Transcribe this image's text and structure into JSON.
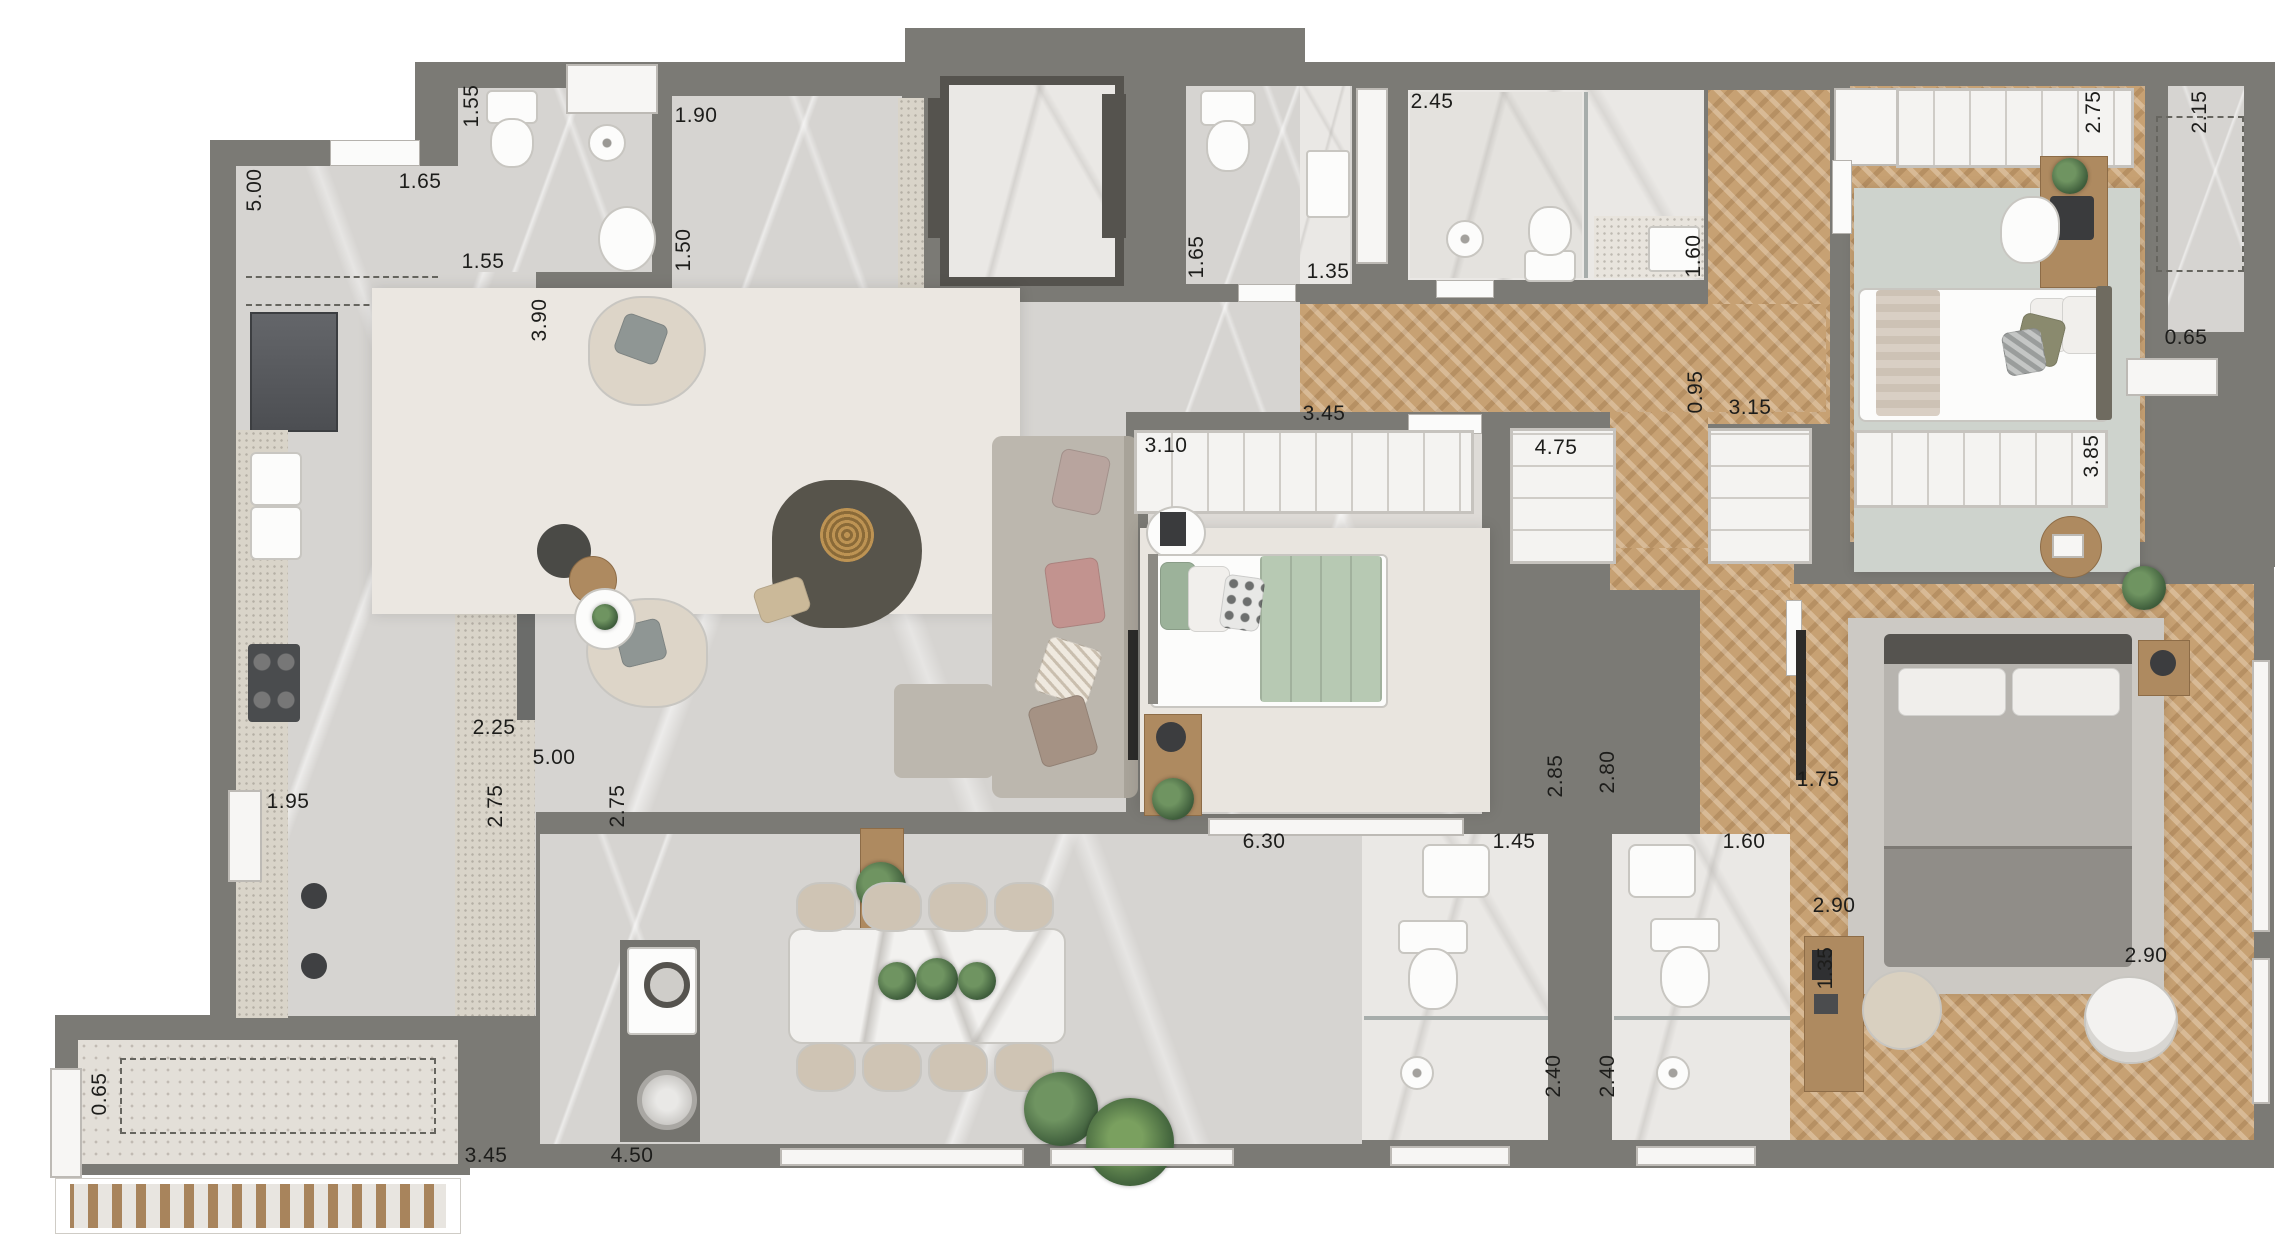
{
  "plan": {
    "canvas": {
      "width": 2280,
      "height": 1257
    },
    "colors": {
      "wall": "#7b7a75",
      "floor_gray_marble": "#d6d4d1",
      "floor_white_marble": "#eae8e5",
      "wood_herringbone": "#c7a173",
      "granite_counter": "#d9d4c9",
      "terrazzo": "#e3dfd8",
      "rug_cream": "#ebe7e1",
      "rug_sage": "#ced3cd",
      "bed_green": "#b7c9b3",
      "gold_decor": "#bd9353",
      "dark_fixture": "#55534e"
    },
    "dimension_labels": [
      {
        "text": "5.00",
        "x": 255,
        "y": 190,
        "v": true
      },
      {
        "text": "1.65",
        "x": 420,
        "y": 182,
        "v": false
      },
      {
        "text": "1.55",
        "x": 472,
        "y": 106,
        "v": true
      },
      {
        "text": "1.55",
        "x": 483,
        "y": 262,
        "v": false
      },
      {
        "text": "3.90",
        "x": 540,
        "y": 320,
        "v": true
      },
      {
        "text": "1.90",
        "x": 696,
        "y": 116,
        "v": false
      },
      {
        "text": "1.50",
        "x": 684,
        "y": 250,
        "v": true
      },
      {
        "text": "1.65",
        "x": 1197,
        "y": 257,
        "v": true
      },
      {
        "text": "1.35",
        "x": 1328,
        "y": 272,
        "v": false
      },
      {
        "text": "2.45",
        "x": 1432,
        "y": 102,
        "v": false
      },
      {
        "text": "1.60",
        "x": 1694,
        "y": 256,
        "v": true
      },
      {
        "text": "2.75",
        "x": 2094,
        "y": 112,
        "v": true
      },
      {
        "text": "2.15",
        "x": 2200,
        "y": 112,
        "v": true
      },
      {
        "text": "0.65",
        "x": 2186,
        "y": 338,
        "v": false
      },
      {
        "text": "3.85",
        "x": 2092,
        "y": 456,
        "v": true
      },
      {
        "text": "3.10",
        "x": 1166,
        "y": 446,
        "v": false
      },
      {
        "text": "3.45",
        "x": 1324,
        "y": 414,
        "v": false
      },
      {
        "text": "4.75",
        "x": 1556,
        "y": 448,
        "v": false
      },
      {
        "text": "0.95",
        "x": 1696,
        "y": 392,
        "v": true
      },
      {
        "text": "3.15",
        "x": 1750,
        "y": 408,
        "v": false
      },
      {
        "text": "2.25",
        "x": 494,
        "y": 728,
        "v": false
      },
      {
        "text": "5.00",
        "x": 554,
        "y": 758,
        "v": false
      },
      {
        "text": "2.75",
        "x": 496,
        "y": 806,
        "v": true
      },
      {
        "text": "2.75",
        "x": 618,
        "y": 806,
        "v": true
      },
      {
        "text": "1.95",
        "x": 288,
        "y": 802,
        "v": false
      },
      {
        "text": "6.30",
        "x": 1264,
        "y": 842,
        "v": false
      },
      {
        "text": "1.45",
        "x": 1514,
        "y": 842,
        "v": false
      },
      {
        "text": "1.60",
        "x": 1744,
        "y": 842,
        "v": false
      },
      {
        "text": "2.85",
        "x": 1556,
        "y": 776,
        "v": true
      },
      {
        "text": "2.80",
        "x": 1608,
        "y": 772,
        "v": true
      },
      {
        "text": "1.75",
        "x": 1818,
        "y": 780,
        "v": false
      },
      {
        "text": "2.90",
        "x": 1834,
        "y": 906,
        "v": false
      },
      {
        "text": "1.35",
        "x": 1826,
        "y": 968,
        "v": true
      },
      {
        "text": "2.40",
        "x": 1554,
        "y": 1076,
        "v": true
      },
      {
        "text": "2.40",
        "x": 1608,
        "y": 1076,
        "v": true
      },
      {
        "text": "2.90",
        "x": 2146,
        "y": 956,
        "v": false
      },
      {
        "text": "0.65",
        "x": 100,
        "y": 1094,
        "v": true
      },
      {
        "text": "3.45",
        "x": 486,
        "y": 1156,
        "v": false
      },
      {
        "text": "4.50",
        "x": 632,
        "y": 1156,
        "v": false
      }
    ]
  }
}
